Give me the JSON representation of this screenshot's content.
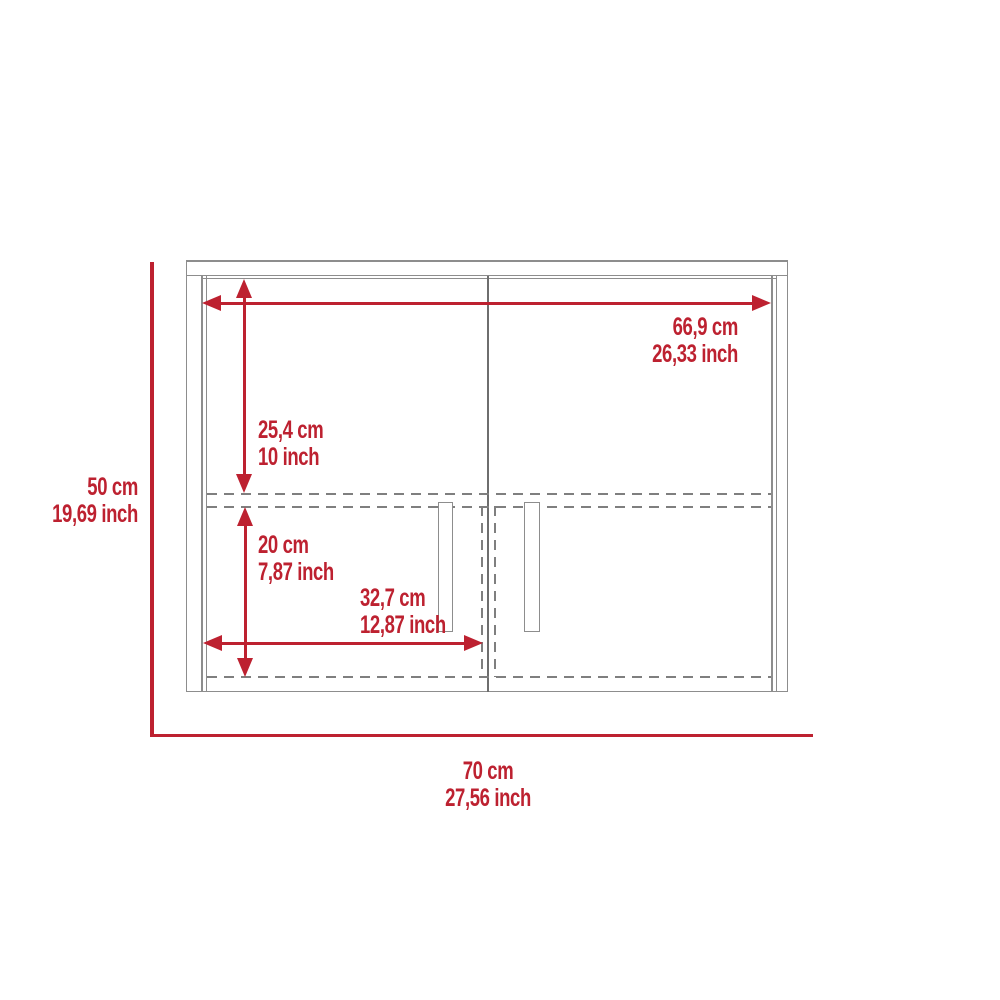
{
  "diagram": {
    "name": "wall-cabinet-dimension-diagram",
    "dims": {
      "inner_width": {
        "cm": "66,9 cm",
        "inch": "26,33 inch"
      },
      "upper_section": {
        "cm": "25,4 cm",
        "inch": "10 inch"
      },
      "lower_section": {
        "cm": "20 cm",
        "inch": "7,87 inch"
      },
      "door_width": {
        "cm": "32,7 cm",
        "inch": "12,87 inch"
      },
      "overall_height": {
        "cm": "50 cm",
        "inch": "19,69 inch"
      },
      "overall_width": {
        "cm": "70 cm",
        "inch": "27,56 inch"
      }
    },
    "colors": {
      "dimension_red": "#bd2130",
      "line_gray": "#8d8d8d",
      "divider_gray": "#6e6e6e",
      "dashed_gray": "#7f7f7f",
      "background": "#ffffff"
    }
  }
}
